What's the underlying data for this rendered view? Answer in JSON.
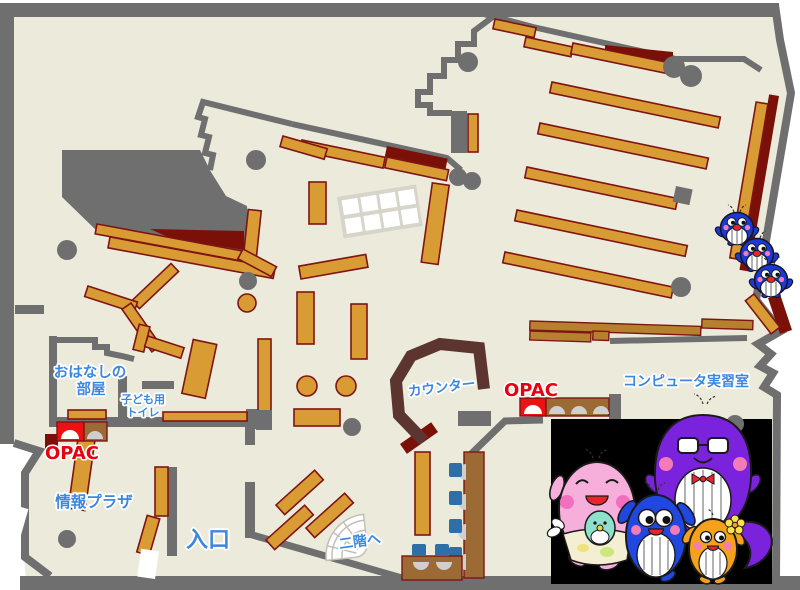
{
  "colors": {
    "floor": "#ECEADB",
    "wall": "#6F6F6F",
    "shelf": "#D99B33",
    "shelf_border": "#7E1414",
    "maroon": "#7A1008",
    "counter": "#5C3531",
    "desk": "#9C6B35",
    "desk2": "#B5812F",
    "chair": "#2F6FA8",
    "seat": "#CFCFCF",
    "label_blue": "#3D87DF",
    "opac_red_text": "#E60012",
    "opac_red": "#EE1111",
    "black_panel": "#000000",
    "grid_table": "#D7D5C9",
    "stair": "#C2C0B6",
    "penguin_blue": "#1D39D4",
    "mom_pink": "#F6AEDA",
    "dad_purple": "#7B22DC",
    "kid_blue": "#2047E0",
    "kid_orange": "#F5A11C",
    "cheek_pink": "#F37BB8",
    "mouth_red": "#E8242C",
    "baby_teal": "#8FE0CB",
    "apron_cream": "#F4EFD2",
    "flower_yellow": "#FFE14D"
  },
  "labels": {
    "storytelling_room_line1": "おはなしの",
    "storytelling_room_line2": "部屋",
    "kids_toilet_line1": "子ども用",
    "kids_toilet_line2": "トイレ",
    "opac_left": "OPAC",
    "opac_right": "OPAC",
    "info_plaza": "情報プラザ",
    "entrance": "入口",
    "counter": "カウンター",
    "computer_room": "コンピュータ実習室",
    "to_second_floor": "二階へ"
  },
  "mascots": {
    "right_edge_trio": "blue-whale-mascots",
    "family_panel": "whale-family-illustration"
  }
}
